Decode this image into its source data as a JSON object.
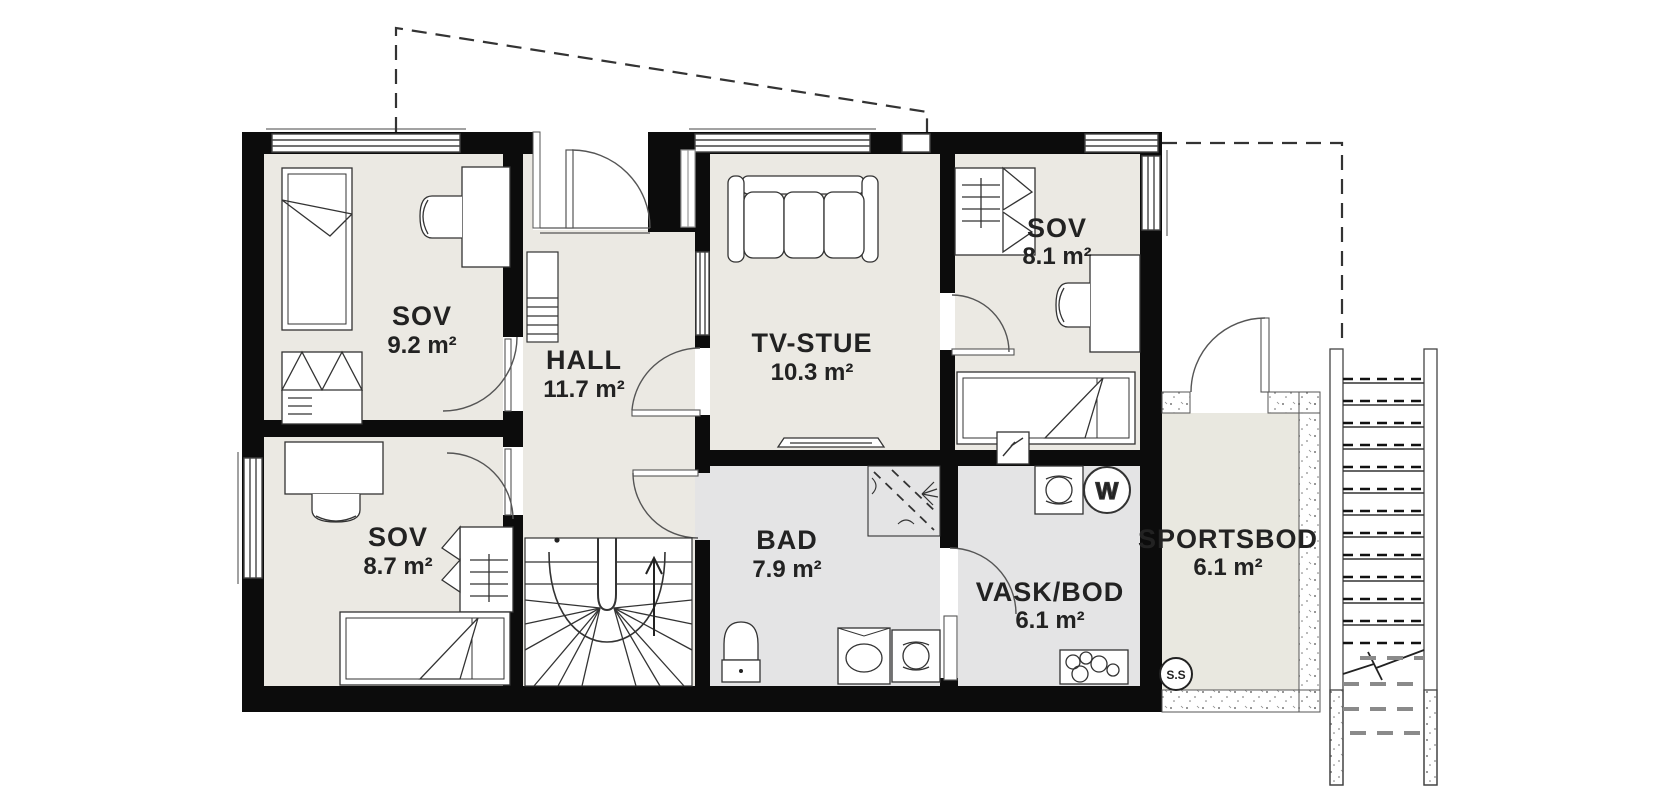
{
  "plan": {
    "title": "Floor plan",
    "rooms": [
      {
        "name": "SOV",
        "area": "9.2 m²"
      },
      {
        "name": "HALL",
        "area": "11.7 m²"
      },
      {
        "name": "TV-STUE",
        "area": "10.3 m²"
      },
      {
        "name": "SOV",
        "area": "8.1 m²"
      },
      {
        "name": "SOV",
        "area": "8.7 m²"
      },
      {
        "name": "BAD",
        "area": "7.9 m²"
      },
      {
        "name": "VASK/BOD",
        "area": "6.1 m²"
      },
      {
        "name": "SPORTSBOD",
        "area": "6.1 m²"
      }
    ],
    "badges": {
      "water_heater": "W",
      "sports_storage": "S.S"
    },
    "colors": {
      "wall": "#0c0c0c",
      "floor_dry": "#ebe9e3",
      "floor_wet": "#e4e4e5",
      "floor_storage": "#e9e8e0",
      "line": "#444444",
      "dashed": "#333333"
    }
  }
}
